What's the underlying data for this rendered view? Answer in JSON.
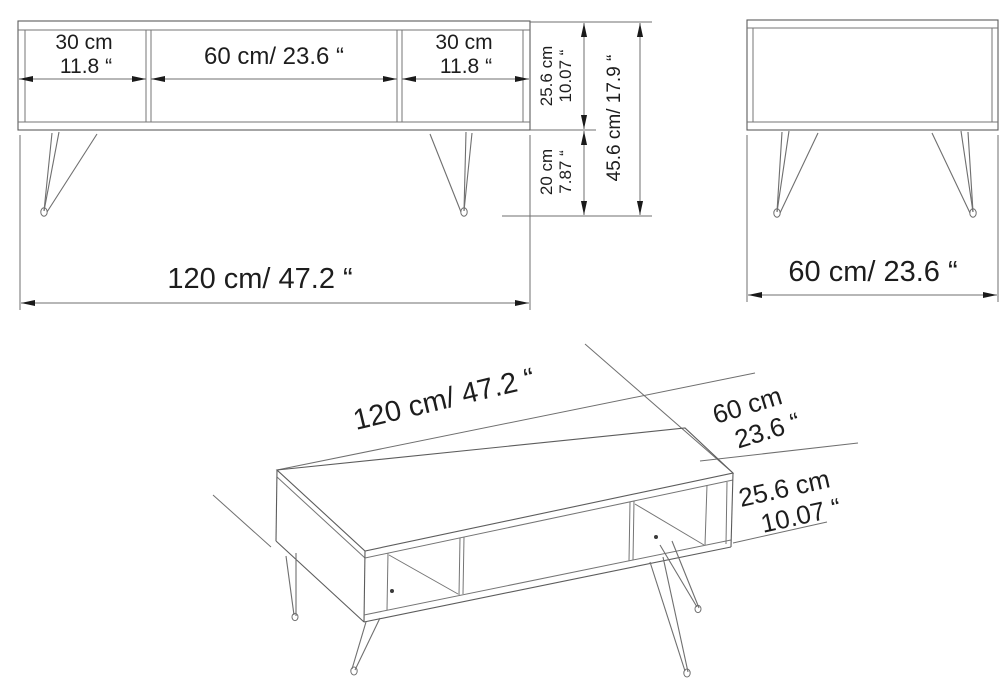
{
  "front_view": {
    "section_left_cm": "30 cm",
    "section_left_in": "11.8 “",
    "section_middle": "60 cm/ 23.6 “",
    "section_right_cm": "30 cm",
    "section_right_in": "11.8 “",
    "carcass_height_cm": "25.6 cm",
    "carcass_height_in": "10.07 “",
    "leg_height_cm": "20 cm",
    "leg_height_in": "7.87 “",
    "total_height": "45.6 cm/ 17.9 “",
    "total_width": "120 cm/ 47.2 “"
  },
  "side_view": {
    "depth": "60 cm/ 23.6 “"
  },
  "isometric_view": {
    "length": "120 cm/ 47.2 “",
    "depth_cm": "60 cm",
    "depth_in": "23.6 “",
    "height_cm": "25.6 cm",
    "height_in": "10.07 “"
  },
  "colors": {
    "line": "#757575",
    "dimension_line": "#6f6f6f",
    "text": "#1d1d1d",
    "background": "#ffffff"
  }
}
